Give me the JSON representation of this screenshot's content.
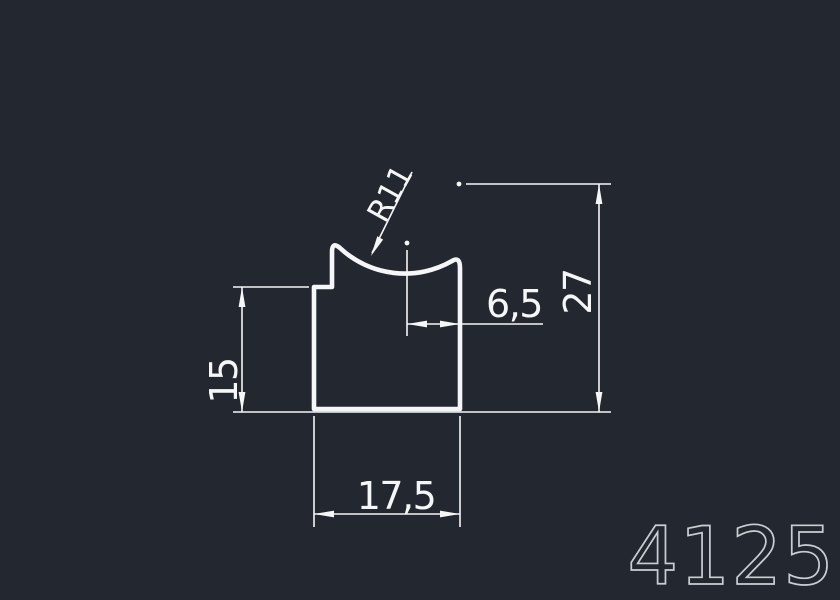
{
  "canvas": {
    "background": "#232830",
    "line_color": "#f4f6f7",
    "part_number_color": "#c9ced3"
  },
  "drawing": {
    "part_number": "4125",
    "dimensions": {
      "radius": "R11",
      "arc_center_offset": "6,5",
      "overall_height": "27",
      "left_height": "15",
      "overall_width": "17,5"
    }
  }
}
